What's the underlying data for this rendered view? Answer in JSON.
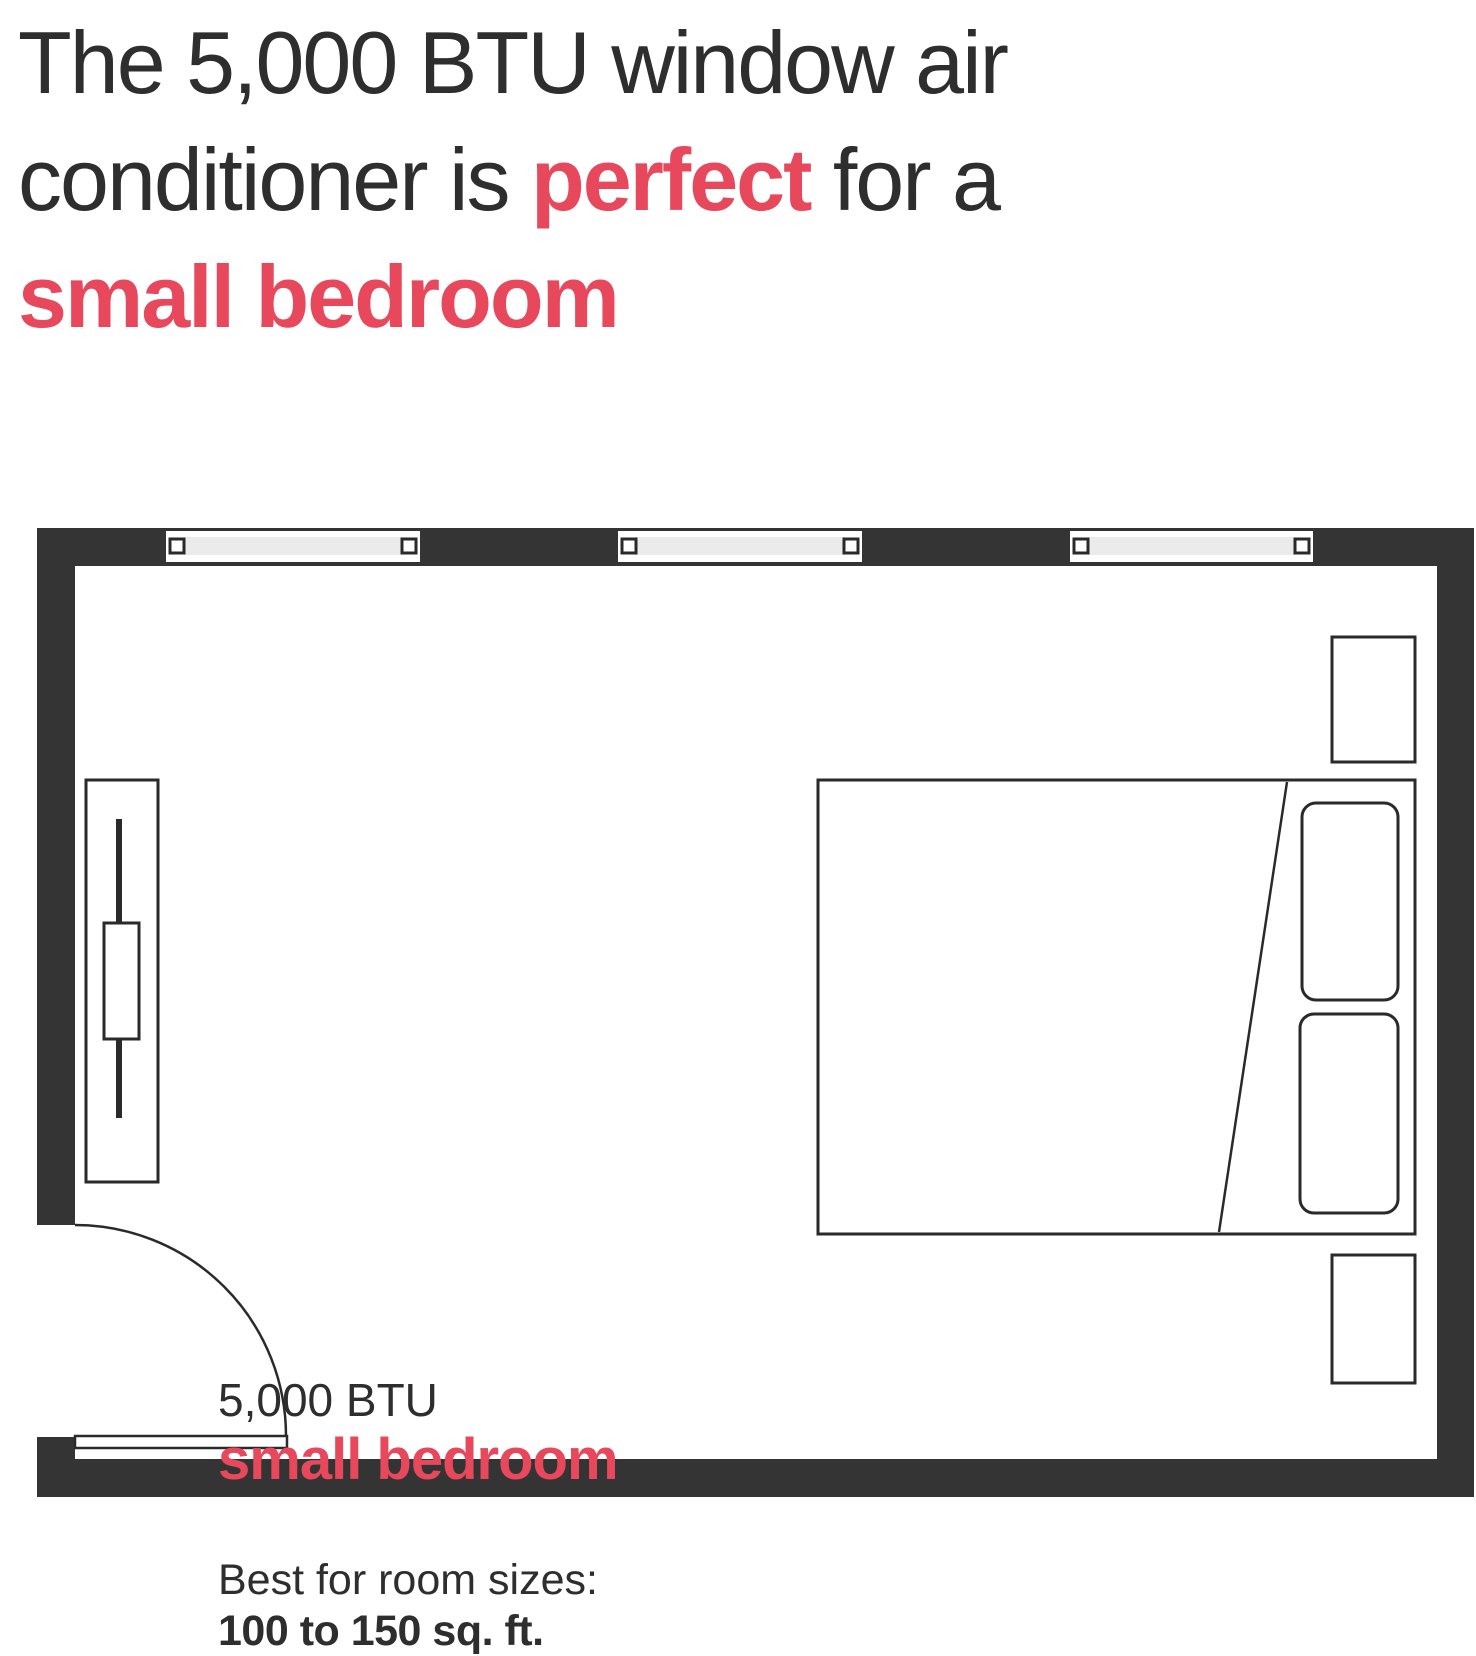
{
  "title": "The 5,000 BTU window air conditioner is perfect for a small bedroom",
  "headline": {
    "line1": "The 5,000 BTU window air",
    "line2_pre": "conditioner is ",
    "line2_highlight": "perfect",
    "line2_post": " for a",
    "line3": "small bedroom"
  },
  "plan_label": {
    "btu": "5,000 BTU",
    "room": "small bedroom",
    "best_for": "Best for room sizes:",
    "size_range": "100 to 150 sq. ft."
  },
  "floorplan": {
    "type": "bedroom floor plan",
    "objects": [
      "window-1",
      "window-2",
      "window-3",
      "window-air-conditioner",
      "bed",
      "pillow-1",
      "pillow-2",
      "nightstand-top",
      "nightstand-bottom",
      "door-leaf",
      "door-swing-arc"
    ],
    "windows_count": 3
  },
  "colors": {
    "accent": "#e8485c",
    "ink": "#2e2e2e",
    "wall": "#343434",
    "outline": "#2a2a2a",
    "glass": "#ebebeb",
    "paper": "#ffffff"
  }
}
